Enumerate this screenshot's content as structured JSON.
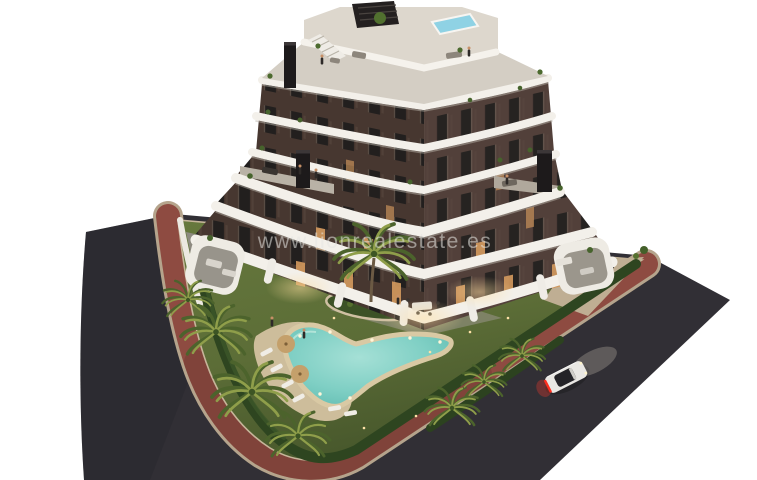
{
  "image": {
    "kind": "real-estate 3D architectural render, aerial dusk view",
    "subject": "modern apartment building with curved white balconies, rooftop pool, landscaped garden with free-form swimming pool, palm trees, perimeter roads and a white car",
    "background": "#ffffff"
  },
  "watermark": {
    "text": "www.lionrealestate.es",
    "color": "rgba(230,230,226,0.55)"
  },
  "colors": {
    "asphalt": "#312f35",
    "sidewalk_red": "#8e4b41",
    "curb_tan": "#b5a48c",
    "pavement_tan": "#bfae93",
    "lawn": "#5c6d37",
    "lawn_dark": "#49592c",
    "hedge": "#2e4520",
    "pool_water": "#7fcfc4",
    "pool_sand": "#d9c9a4",
    "deck_sand": "#cdbd9b",
    "facade_left": "#473730",
    "facade_right": "#52403a",
    "window_dark": "#221f1e",
    "window_lit": "#d49a5e",
    "band_white": "#f3f0ea",
    "roof_deck": "#d4cec4",
    "top_deck": "#ddd7cd",
    "rooftop_pool": "#8fd2e4",
    "pergola": "#242020",
    "chimney": "#1d1a1b",
    "palm_green": "#5e7836",
    "palm_light": "#8f9e4a",
    "trunk": "#6b5a44",
    "car_body": "#e9e7e3",
    "car_glass": "#242327",
    "taillight": "#ff2e1e",
    "umbrella": "#c4a06b",
    "lounger": "#f0ede6"
  },
  "scene": {
    "building_floors_visible": 7,
    "roads": "two dark asphalt roads meeting at rounded corner, red pedestrian strip along plot",
    "car": "white sedan driving uphill with headlights on and red taillights",
    "pool": "free-form boomerang pool with sand rim, sun loungers and two parasols",
    "rooftop": "roof terrace with small pool, pergola, stairs and lounge furniture"
  }
}
